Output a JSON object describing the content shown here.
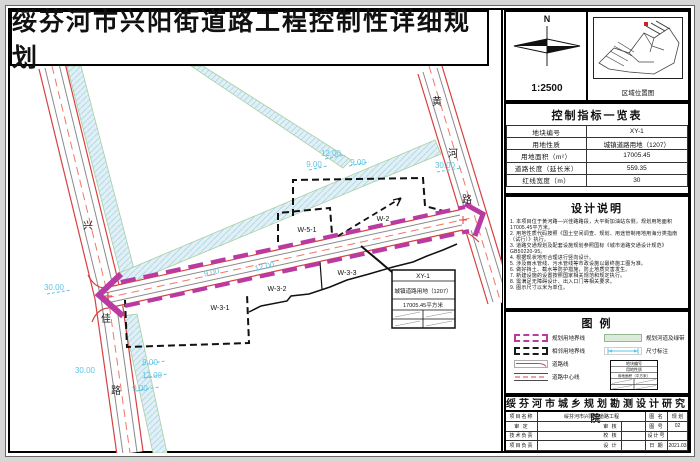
{
  "title": "绥芬河市兴阳街道路工程控制性详细规划",
  "compass": {
    "north": "N",
    "scale": "1:2500"
  },
  "location": {
    "caption": "区域位置图"
  },
  "control_table": {
    "title": "控制指标一览表",
    "rows": [
      {
        "label": "地块编号",
        "value": "XY-1"
      },
      {
        "label": "用地性质",
        "value": "城镇道路用地（1207）"
      },
      {
        "label": "用地面积（m²）",
        "value": "17005.45"
      },
      {
        "label": "道路长度（延长米）",
        "value": "559.35"
      },
      {
        "label": "红线宽度（m）",
        "value": "30"
      }
    ]
  },
  "design_notes": {
    "title": "设计说明",
    "items": [
      "1. 本项目位于黄河路—兴佳路路段，大平街加油站东侧，规划用地面积17005.45平方米。",
      "2. 用地性质代码按照《国土空间调查、规划、用途管制用地用海分类指南（试行）》执行。",
      "3. 道路交通规划及配套设施规划参照国标《城市道路交通设计规范》GB50220-95。",
      "4. 根据现状地形合理进行竖向设计。",
      "5. 涉及雨水管线、污水管线等市政设施以最终施工图为准。",
      "6. 做好挡土、截水等防护措施，防止地质灾害发生。",
      "7. 新建设施的设置按照国家相关规范和规定执行。",
      "8. 需满足无障碍设计、出入口门等相关要求。",
      "9. 图示尺寸以米为单位。"
    ]
  },
  "legend": {
    "title": "图  例",
    "items_left": [
      {
        "label": "规划用地界线"
      },
      {
        "label": "相邻用地界线"
      },
      {
        "label": "道路线"
      },
      {
        "label": "道路中心线"
      }
    ],
    "items_right": [
      {
        "label": "规划河道及绿带"
      },
      {
        "label": "尺寸标注"
      }
    ],
    "mini_table": {
      "r1": "地块编号",
      "r2": "用地性质",
      "r3": "用地面积（平方米）"
    }
  },
  "title_block": {
    "institute": "绥芬河市城乡规划勘测设计研究院",
    "project_label": "项目名称",
    "project_value": "绥芬河市兴阳街道路工程",
    "drawing_label": "图 名",
    "drawing_value": "规 划",
    "row2": {
      "c1": "审 定",
      "c3": "审 核",
      "c5": "图 号",
      "c6": "02"
    },
    "row3": {
      "c1": "技术负责",
      "c3": "校 核",
      "c5": "设计号",
      "c6": ""
    },
    "row4": {
      "c1": "项目负责",
      "c3": "设 计",
      "c5": "日 期",
      "c6": "2021.03"
    }
  },
  "map": {
    "road_names": {
      "xingjia": [
        "兴",
        "佳",
        "路"
      ],
      "huanghe": [
        "黄",
        "河",
        "路"
      ]
    },
    "parcels": [
      "W-5-1",
      "W-2",
      "W-3-1",
      "W-3-2",
      "W-3-3"
    ],
    "dims": [
      "12.00",
      "9.00",
      "9.00",
      "30.00",
      "9.00",
      "12.00",
      "30.00",
      "30.00",
      "9.00",
      "12.00",
      "9.00"
    ],
    "info_box": {
      "code": "XY-1",
      "use": "城镇道路用地（1207）",
      "area": "17005.45平方米"
    }
  },
  "colors": {
    "planned_boundary": "#b93aa3",
    "road_edge": "#d84040",
    "centerline": "#f0776a",
    "dimension": "#5fc4e4",
    "channel_fill": "#e2f0f5",
    "parcel_line": "#111111"
  }
}
